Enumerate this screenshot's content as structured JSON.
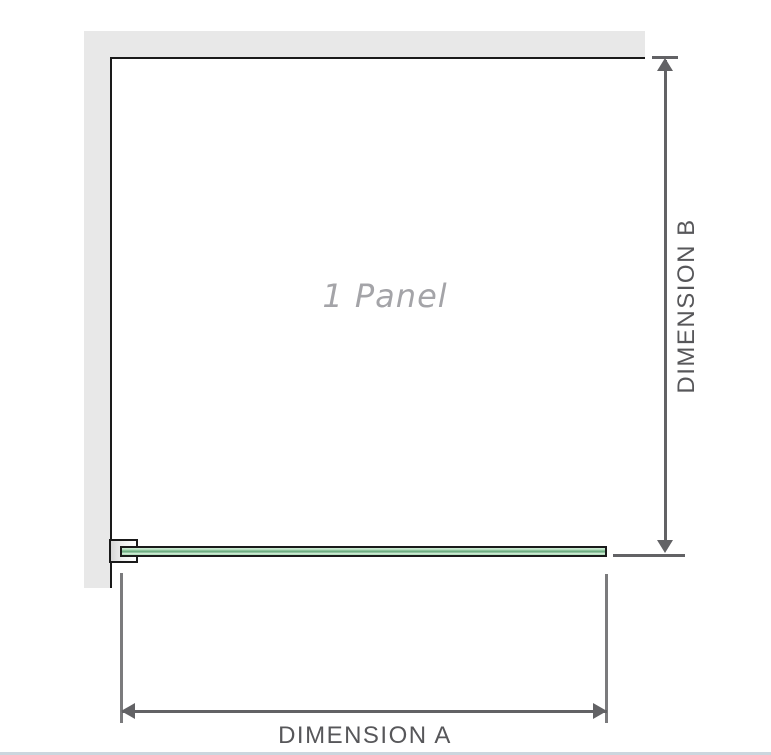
{
  "diagram": {
    "panel_label": "1 Panel",
    "dimension_a": {
      "label": "DIMENSION A"
    },
    "dimension_b": {
      "label": "DIMENSION B"
    },
    "colors": {
      "wall": "#e8e8e8",
      "outline": "#1a1a1a",
      "panel_fill": "#a8dab3",
      "panel_fill_light": "#d2ecd8",
      "panel_stripe": "#6fae83",
      "dimension_line": "#626265",
      "extension_line": "#7b7b7d",
      "label_text": "#57575a",
      "panel_label_text": "#a4a4a8",
      "bottom_divider": "#ccd6de"
    }
  }
}
